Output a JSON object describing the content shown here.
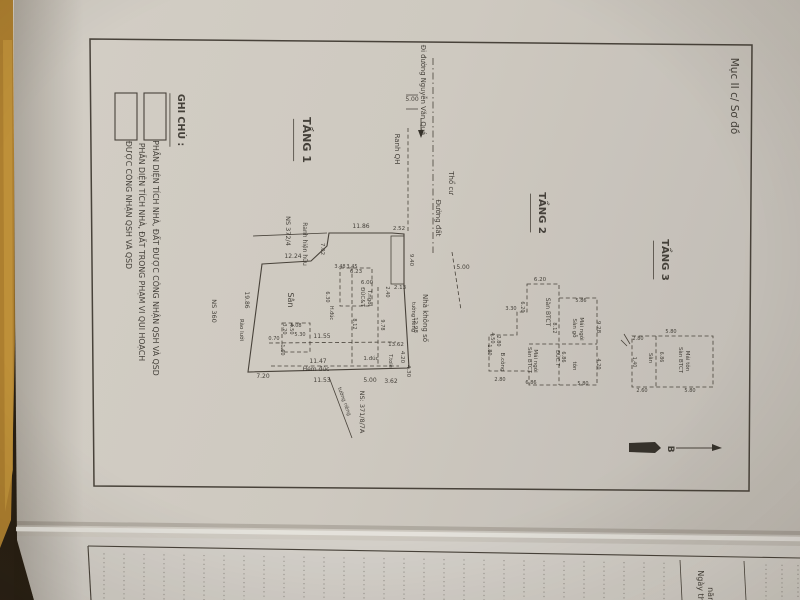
{
  "meta": {
    "description": "Photographed Vietnamese cadastral certificate page, section 'Mục II c/ Sơ đồ', showing hand-surveyed floor plans TẦNG 1, TẦNG 2, TẦNG 3 with legend, dimensions in meters, north arrow B, over the edge of a second lined page."
  },
  "colors": {
    "backdrop": "#241c13",
    "strip": "#b08130",
    "strip_bright": "#c89a3e",
    "paper": "#d5d1cb",
    "paper2": "#d9d6d2",
    "ink": "#33302c",
    "line": "#46413b"
  },
  "header": {
    "section_label": "Mục II c/ Sơ đồ"
  },
  "legend": {
    "title": "GHI CHÚ :",
    "items": [
      {
        "symbol": "white-rect",
        "label": "PHẦN DIỆN TÍCH NHÀ, ĐẤT ĐƯỢC CÔNG NHẬN QSH VÀ QSD"
      },
      {
        "symbol": "hatched-rect",
        "label": "PHẦN DIỆN TÍCH NHÀ, ĐẤT TRONG PHẠM VI QUI HOẠCH ĐƯỢC CÔNG NHẬN QSH VÀ QSD"
      }
    ]
  },
  "floors": [
    {
      "name": "TẦNG 1"
    },
    {
      "name": "TẦNG 2"
    },
    {
      "name": "TẦNG 3"
    }
  ],
  "compass": {
    "north_label": "B"
  },
  "next_page": {
    "date_line": "Ngày th… năm…"
  },
  "texts": [
    {
      "n": "section-label",
      "t": "Mục II c/ Sơ đồ",
      "x": 731,
      "y": 96,
      "s": 10.5
    },
    {
      "n": "legend-title",
      "t": "GHI CHÚ :",
      "x": 178,
      "y": 120,
      "s": 9.5,
      "b": 1,
      "u": 1
    },
    {
      "n": "legend-item1-label",
      "t": "PHẦN DIỆN TÍCH NHÀ, ĐẤT ĐƯỢC CÔNG NHẬN QSH VÀ QSD",
      "x": 153,
      "y": 258,
      "s": 7.8
    },
    {
      "n": "legend-item2-label-line1",
      "t": "PHẦN DIỆN TÍCH NHÀ, ĐẤT TRONG PHẠM VI QUI HOẠCH",
      "x": 139,
      "y": 252,
      "s": 7.8
    },
    {
      "n": "legend-item2-label-line2",
      "t": "ĐƯỢC CÔNG NHẬN QSH VÀ QSD",
      "x": 126,
      "y": 205,
      "s": 7.8
    },
    {
      "n": "floor1-title",
      "t": "TẦNG 1",
      "x": 303,
      "y": 140,
      "s": 11,
      "b": 1,
      "u": 1
    },
    {
      "n": "floor2-title",
      "t": "TẦNG 2",
      "x": 539,
      "y": 213,
      "s": 10,
      "b": 1,
      "u": 1
    },
    {
      "n": "floor3-title",
      "t": "TẦNG 3",
      "x": 662,
      "y": 260,
      "s": 10,
      "b": 1,
      "u": 1
    },
    {
      "n": "street-direction-label",
      "t": "Đi đường Nguyễn Văn Quá",
      "x": 421,
      "y": 90,
      "s": 6.8
    },
    {
      "n": "road-width-top",
      "t": "5.00",
      "x": 412,
      "y": 101,
      "s": 6,
      "a": 0
    },
    {
      "n": "planning-boundary-label",
      "t": "Ranh QH",
      "x": 395,
      "y": 149,
      "s": 7
    },
    {
      "n": "dirt-road-label",
      "t": "Đường đất",
      "x": 436,
      "y": 218,
      "s": 7
    },
    {
      "n": "residential-land-label",
      "t": "Thổ cư",
      "x": 449,
      "y": 183,
      "s": 7
    },
    {
      "n": "road-width-bottom",
      "t": "5.00",
      "x": 463,
      "y": 269,
      "s": 6,
      "a": 0
    },
    {
      "n": "neighbor-ns-372-4",
      "t": "NS 372/4",
      "x": 286,
      "y": 231,
      "s": 6.5
    },
    {
      "n": "existing-boundary-label",
      "t": "Ranh hiện hữu",
      "x": 303,
      "y": 244,
      "s": 6
    },
    {
      "n": "neighbor-ns-360",
      "t": "NS 360",
      "x": 212,
      "y": 311,
      "s": 6.5
    },
    {
      "n": "neighbor-ns-371-8-7a",
      "t": "NS: 371/8/7A",
      "x": 360,
      "y": 412,
      "s": 6.5
    },
    {
      "n": "neighbor-no-number-house",
      "t": "Nhà không số",
      "x": 423,
      "y": 318,
      "s": 7
    },
    {
      "n": "private-wall-right",
      "t": "tường riêng",
      "x": 412,
      "y": 317,
      "s": 5.2
    },
    {
      "n": "private-wall-bottom",
      "t": "tường riêng",
      "x": 343,
      "y": 402,
      "s": 5.2,
      "a": 70
    },
    {
      "n": "wire-fence-label",
      "t": "Rào lưới",
      "x": 240,
      "y": 330,
      "s": 5.5
    },
    {
      "n": "t1-dim",
      "t": "11.86",
      "x": 361,
      "y": 228,
      "s": 6,
      "a": 0
    },
    {
      "n": "t1-dim",
      "t": "2.52",
      "x": 399,
      "y": 230,
      "s": 5.5,
      "a": 0
    },
    {
      "n": "t1-dim",
      "t": "9.40",
      "x": 410,
      "y": 260,
      "s": 5.5
    },
    {
      "n": "t1-dim",
      "t": "2.13",
      "x": 400,
      "y": 289,
      "s": 5.5,
      "a": 0
    },
    {
      "n": "t1-dim",
      "t": "12.98",
      "x": 414,
      "y": 325,
      "s": 5.5
    },
    {
      "n": "t1-dim",
      "t": "12.24",
      "x": 293,
      "y": 258,
      "s": 6,
      "a": 0
    },
    {
      "n": "t1-dim",
      "t": "7.02",
      "x": 321,
      "y": 249,
      "s": 5.5
    },
    {
      "n": "t1-dim",
      "t": "19.86",
      "x": 245,
      "y": 300,
      "s": 6
    },
    {
      "n": "t1-dim",
      "t": "7.20",
      "x": 263,
      "y": 378,
      "s": 6,
      "a": 0
    },
    {
      "n": "t1-dim",
      "t": "11.53",
      "x": 322,
      "y": 382,
      "s": 6,
      "a": 0
    },
    {
      "n": "t1-dim",
      "t": "5.00",
      "x": 370,
      "y": 382,
      "s": 6,
      "a": 0
    },
    {
      "n": "t1-dim",
      "t": "3.62",
      "x": 391,
      "y": 383,
      "s": 6,
      "a": 0
    },
    {
      "n": "t1-dim",
      "t": "11.47",
      "x": 318,
      "y": 363,
      "s": 6,
      "a": 0
    },
    {
      "n": "t1-dim",
      "t": "11.55",
      "x": 322,
      "y": 338,
      "s": 6,
      "a": 0
    },
    {
      "n": "t1-dim",
      "t": "13.62",
      "x": 396,
      "y": 346,
      "s": 5.5,
      "a": 0
    },
    {
      "n": "t1-dim",
      "t": "4.20",
      "x": 401,
      "y": 357,
      "s": 5.5
    },
    {
      "n": "t1-dim",
      "t": "4.30",
      "x": 407,
      "y": 371,
      "s": 5.5
    },
    {
      "n": "t1-alley-label",
      "t": "Hẻm đúc",
      "x": 316,
      "y": 371,
      "s": 6,
      "a": 0
    },
    {
      "n": "t1-dim",
      "t": "1.đúc",
      "x": 371,
      "y": 360,
      "s": 5.5,
      "a": 0
    },
    {
      "n": "t1-dim",
      "t": "T.tole",
      "x": 389,
      "y": 361,
      "s": 5
    },
    {
      "n": "t1-yard-label",
      "t": "Sân",
      "x": 288,
      "y": 300,
      "s": 8
    },
    {
      "n": "t1-dim",
      "t": "6.00",
      "x": 367,
      "y": 284,
      "s": 5.5,
      "a": 0
    },
    {
      "n": "t1-room-label",
      "t": "ĐÚC&T",
      "x": 361,
      "y": 297,
      "s": 5.5
    },
    {
      "n": "t1-room-label",
      "t": "T.ngói",
      "x": 368,
      "y": 298,
      "s": 5.5
    },
    {
      "n": "t1-dim",
      "t": "6.23",
      "x": 356,
      "y": 273,
      "s": 5.5,
      "a": 0
    },
    {
      "n": "t1-dim",
      "t": "3.48",
      "x": 340,
      "y": 268,
      "s": 5,
      "a": 0
    },
    {
      "n": "t1-dim",
      "t": "3.45",
      "x": 352,
      "y": 268,
      "s": 5,
      "a": 0
    },
    {
      "n": "t1-dim",
      "t": "2.40",
      "x": 386,
      "y": 292,
      "s": 5
    },
    {
      "n": "t1-dim",
      "t": "9.78",
      "x": 381,
      "y": 325,
      "s": 5
    },
    {
      "n": "t1-dim",
      "t": "8.12",
      "x": 353,
      "y": 324,
      "s": 5
    },
    {
      "n": "t1-room-label",
      "t": "H.đúc",
      "x": 330,
      "y": 313,
      "s": 5
    },
    {
      "n": "t1-dim",
      "t": "6.30",
      "x": 326,
      "y": 297,
      "s": 5
    },
    {
      "n": "t1-dim",
      "t": "5.08",
      "x": 296,
      "y": 327,
      "s": 5,
      "a": 0
    },
    {
      "n": "t1-dim",
      "t": "5.30",
      "x": 300,
      "y": 336,
      "s": 5,
      "a": 0
    },
    {
      "n": "t1-dim",
      "t": "4.50",
      "x": 290,
      "y": 329,
      "s": 5
    },
    {
      "n": "t1-dim",
      "t": "3.20",
      "x": 283,
      "y": 329,
      "s": 5
    },
    {
      "n": "t1-dim",
      "t": "0.70",
      "x": 274,
      "y": 340,
      "s": 5,
      "a": 0
    },
    {
      "n": "t1-dim",
      "t": "1.60",
      "x": 281,
      "y": 350,
      "s": 5
    },
    {
      "n": "t2-dim",
      "t": "6.20",
      "x": 540,
      "y": 281,
      "s": 5.5,
      "a": 0
    },
    {
      "n": "t2-dim",
      "t": "6.20",
      "x": 521,
      "y": 307,
      "s": 5
    },
    {
      "n": "t2-dim",
      "t": "3.30",
      "x": 511,
      "y": 310,
      "s": 5,
      "a": 0
    },
    {
      "n": "t2-room-label",
      "t": "Sàn BTCT",
      "x": 546,
      "y": 312,
      "s": 6
    },
    {
      "n": "t2-room-label",
      "t": "Sàn gỗ",
      "x": 573,
      "y": 328,
      "s": 5.5
    },
    {
      "n": "t2-room-label",
      "t": "Mái ngói",
      "x": 580,
      "y": 329,
      "s": 5.5
    },
    {
      "n": "t2-dim",
      "t": "9.28",
      "x": 597,
      "y": 327,
      "s": 5.5
    },
    {
      "n": "t2-dim",
      "t": "5.86",
      "x": 581,
      "y": 302,
      "s": 5,
      "a": 0
    },
    {
      "n": "t2-dim",
      "t": "8.12",
      "x": 553,
      "y": 328,
      "s": 5
    },
    {
      "n": "t2-room-label",
      "t": "Sàn BTCT",
      "x": 528,
      "y": 360,
      "s": 5.5
    },
    {
      "n": "t2-room-label",
      "t": "Mái ngói",
      "x": 534,
      "y": 361,
      "s": 5.5
    },
    {
      "n": "t2-dim",
      "t": "6.86",
      "x": 531,
      "y": 384,
      "s": 5,
      "a": 0
    },
    {
      "n": "t2-room-label",
      "t": "ĐÚC.T",
      "x": 556,
      "y": 358,
      "s": 5
    },
    {
      "n": "t2-dim",
      "t": "6.86",
      "x": 562,
      "y": 357,
      "s": 5
    },
    {
      "n": "t2-room-label",
      "t": "tôn",
      "x": 573,
      "y": 366,
      "s": 5.5
    },
    {
      "n": "t2-dim",
      "t": "4.20",
      "x": 597,
      "y": 364,
      "s": 5
    },
    {
      "n": "t2-dim",
      "t": "5.80",
      "x": 583,
      "y": 385,
      "s": 5,
      "a": 0
    },
    {
      "n": "t2-balcony-label",
      "t": "B.công",
      "x": 501,
      "y": 362,
      "s": 5.5
    },
    {
      "n": "t2-dim",
      "t": "4.50",
      "x": 491,
      "y": 338,
      "s": 5
    },
    {
      "n": "t2-dim",
      "t": "2.80",
      "x": 497,
      "y": 341,
      "s": 5
    },
    {
      "n": "t2-dim",
      "t": "1.80",
      "x": 488,
      "y": 350,
      "s": 5
    },
    {
      "n": "t2-dim",
      "t": "2.80",
      "x": 500,
      "y": 381,
      "s": 5,
      "a": 0
    },
    {
      "n": "t3-room-label",
      "t": "Sàn BTCT",
      "x": 679,
      "y": 360,
      "s": 5.5
    },
    {
      "n": "t3-room-label",
      "t": "Mái tôn",
      "x": 686,
      "y": 361,
      "s": 5.5
    },
    {
      "n": "t3-yard-label",
      "t": "Sân",
      "x": 649,
      "y": 358,
      "s": 5.5
    },
    {
      "n": "t3-dim",
      "t": "2.80",
      "x": 638,
      "y": 340,
      "s": 5,
      "a": 0
    },
    {
      "n": "t3-dim",
      "t": "2.60",
      "x": 642,
      "y": 392,
      "s": 5,
      "a": 0
    },
    {
      "n": "t3-dim",
      "t": "5.80",
      "x": 671,
      "y": 333,
      "s": 5,
      "a": 0
    },
    {
      "n": "t3-dim",
      "t": "5.80",
      "x": 690,
      "y": 392,
      "s": 5,
      "a": 0
    },
    {
      "n": "t3-dim",
      "t": "6.86",
      "x": 660,
      "y": 357,
      "s": 4.8
    },
    {
      "n": "t3-dim",
      "t": "1.40",
      "x": 633,
      "y": 362,
      "s": 4.8
    },
    {
      "n": "north-label",
      "t": "B",
      "x": 668,
      "y": 449,
      "s": 9,
      "b": 1
    },
    {
      "n": "next-page-date-line1",
      "t": "Ngày th",
      "x": 698,
      "y": 586,
      "s": 8
    },
    {
      "n": "next-page-date-line2",
      "t": "năm",
      "x": 708,
      "y": 596,
      "s": 8
    }
  ]
}
